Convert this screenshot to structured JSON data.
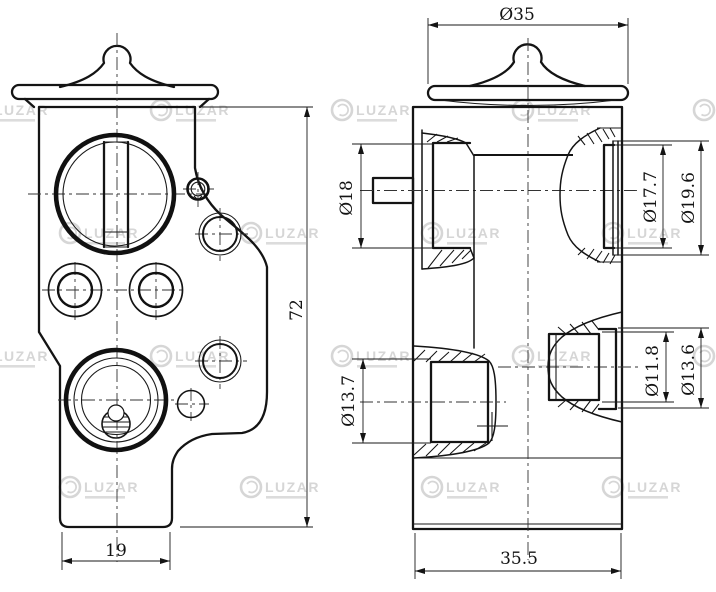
{
  "drawing": {
    "type": "technical-drawing",
    "part": "expansion-valve",
    "front_view": {
      "dims": {
        "base_width": "19",
        "height": "72"
      }
    },
    "section_view": {
      "dims": {
        "cap_diameter": "Ø35",
        "inlet_port": "Ø18",
        "upper_outlet_inner": "Ø17.7",
        "upper_outlet_outer": "Ø19.6",
        "lower_inlet": "Ø13.7",
        "lower_outlet_inner": "Ø11.8",
        "lower_outlet_outer": "Ø13.6",
        "body_depth": "35.5"
      }
    },
    "colors": {
      "background": "#ffffff",
      "line": "#141414",
      "watermark": "#d6d6d6"
    }
  },
  "watermark": {
    "brand": "LUZAR",
    "color": "#d6d6d6"
  }
}
